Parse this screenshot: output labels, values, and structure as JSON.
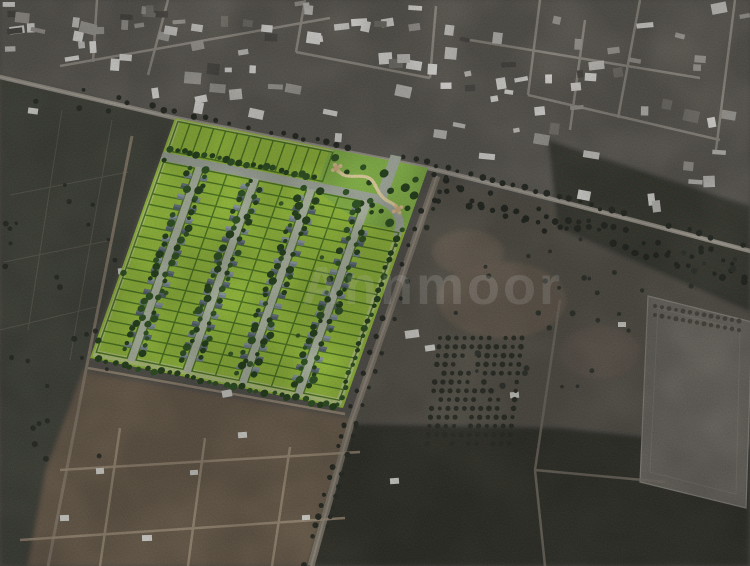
{
  "watermark": {
    "text": "Annmoor",
    "color": "#ffffff",
    "opacity": 0.17
  },
  "palette": {
    "sat_base": "#56534d",
    "sat_urban": "#615d56",
    "sat_field": "#45463e",
    "sat_dirt": "#6d5e4e",
    "sat_dark": "#35362f",
    "sat_scrub": "#59544b",
    "sat_pad": "#6f6b64",
    "sat_road": "#9b968c",
    "dirt_road": "#a5947e",
    "lot_green": "#9cc63d",
    "lot_line": "#4f7c1f",
    "street_light": "#b7c0ab",
    "spine_gray": "#a8b0a2",
    "perimeter": "#c6d295",
    "house_dark": "#55636f",
    "house_light": "#7e8c98",
    "tree_dark": "#24421a",
    "tree_mid": "#2f5522",
    "park_lawn": "#8abb4a",
    "park_path": "#ead9a4",
    "gazebo": "#d9b585",
    "roof_white": "#e7e6e2"
  }
}
